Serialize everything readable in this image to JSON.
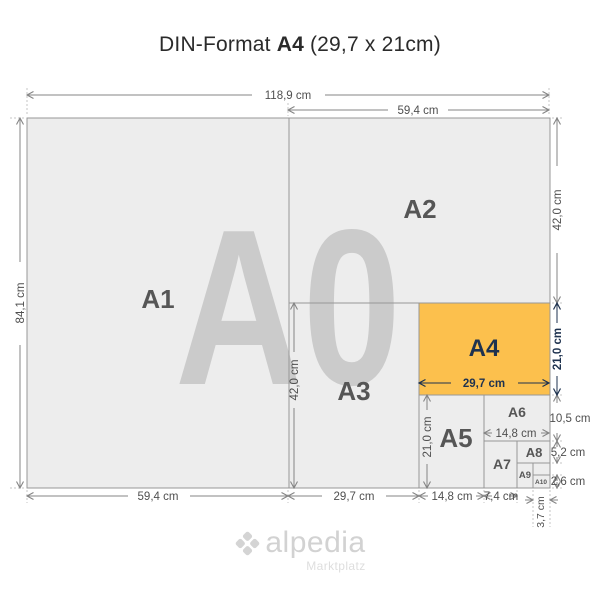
{
  "title": {
    "prefix": "DIN-Format",
    "format": "A4",
    "suffix": "(29,7 x 21cm)"
  },
  "watermark": "A0",
  "formats": {
    "a1": "A1",
    "a2": "A2",
    "a3": "A3",
    "a4": "A4",
    "a5": "A5",
    "a6": "A6",
    "a7": "A7",
    "a8": "A8",
    "a9": "A9",
    "a10": "A10"
  },
  "dimensions": {
    "top_width": "118,9 cm",
    "top_half_width": "59,4 cm",
    "left_height": "84,1 cm",
    "right_a2_height": "42,0 cm",
    "right_a4_height": "21,0 cm",
    "right_a6_height": "10,5 cm",
    "right_a8_height": "5,2 cm",
    "right_a10_height": "2,6 cm",
    "a3_height": "42,0 cm",
    "a4_width": "29,7 cm",
    "a5_height": "21,0 cm",
    "a6_width": "14,8 cm",
    "bottom_a1_width": "59,4 cm",
    "bottom_a3_width": "29,7 cm",
    "bottom_a5_width": "14,8 cm",
    "bottom_a7_width": "7,4 cm",
    "bottom_a10_width": "3,7 cm"
  },
  "colors": {
    "highlight_orange": "#fcc04d",
    "accent_navy": "#1e324f",
    "sheet_gray": "#ededed"
  },
  "footer": {
    "brand": "alpedia",
    "tagline": "Marktplatz"
  }
}
